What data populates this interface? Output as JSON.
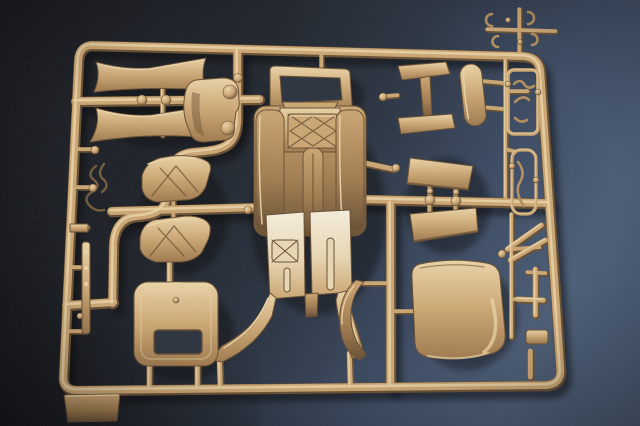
{
  "meta": {
    "domain": "Natural-Image",
    "subject": "Photograph of a dark-yellow tan plastic model kit sprue (parts tree) lying on a dark blue textured surface",
    "lighting": "light from upper left, soft shadows cast down-right, background brightens to slate blue on the right side"
  },
  "colors": {
    "bg_left": "#101216",
    "bg_mid": "#171b22",
    "bg_mid2": "#242d3b",
    "bg_blue": "#35445c",
    "bg_blue2": "#44566f",
    "plastic_light": "#e8d0a2",
    "plastic_mid": "#c9a26d",
    "plastic_mid2": "#b8905c",
    "plastic_dark": "#9a7446",
    "plastic_deep": "#63492b",
    "floor_hi": "#f4ecd9",
    "floor_mid": "#e6d4ae",
    "window_hole": "#242b36",
    "wire_dark": "#6e5435",
    "clip_shadowed": "#b08a55",
    "shadow": "#05070c"
  },
  "parts": [
    {
      "id": "outer-frame",
      "label": "rectangular sprue frame runner with rounded corners"
    },
    {
      "id": "horn-upper",
      "label": "flared horn-shaped section, upper left"
    },
    {
      "id": "horn-lower",
      "label": "flared horn-shaped section with bell tip, left"
    },
    {
      "id": "bonnet",
      "label": "rounded bonnet shell with two round bosses"
    },
    {
      "id": "windshield-frame",
      "label": "windscreen frame with open centre"
    },
    {
      "id": "i-beam-bracket",
      "label": "I-section bracket part, upper middle right"
    },
    {
      "id": "oval-board",
      "label": "long oval board part"
    },
    {
      "id": "mudguard-upper",
      "label": "ribbed curved mudguard, upper"
    },
    {
      "id": "mudguard-lower",
      "label": "ribbed curved mudguard, lower"
    },
    {
      "id": "wire-lines",
      "label": "thin bent wire piping part"
    },
    {
      "id": "chassis-floor",
      "label": "central floor pan with tread plates, tunnel and two front fenders"
    },
    {
      "id": "cab-rear-panel",
      "label": "cab rear panel with rectangular window opening"
    },
    {
      "id": "door-panel-upper",
      "label": "trapezoid flat panel, upper"
    },
    {
      "id": "door-panel-lower",
      "label": "trapezoid flat panel, lower"
    },
    {
      "id": "crescent-fender",
      "label": "crescent fender blade"
    },
    {
      "id": "seat-back-panel",
      "label": "large curved seat back / roof panel"
    },
    {
      "id": "ladder-loop-a",
      "label": "small clip parts inside runner loop, upper right"
    },
    {
      "id": "ladder-loop-b",
      "label": "small parts runner loop, right"
    },
    {
      "id": "rod-cluster",
      "label": "thin rods, levers and paddle, lower right"
    },
    {
      "id": "corner-clips",
      "label": "tiny C-clip parts above top right corner"
    },
    {
      "id": "left-small-parts",
      "label": "small strip, brackets and knobs along left rail"
    },
    {
      "id": "corner-tab",
      "label": "moulded rectangular tab at lower left corner"
    }
  ]
}
